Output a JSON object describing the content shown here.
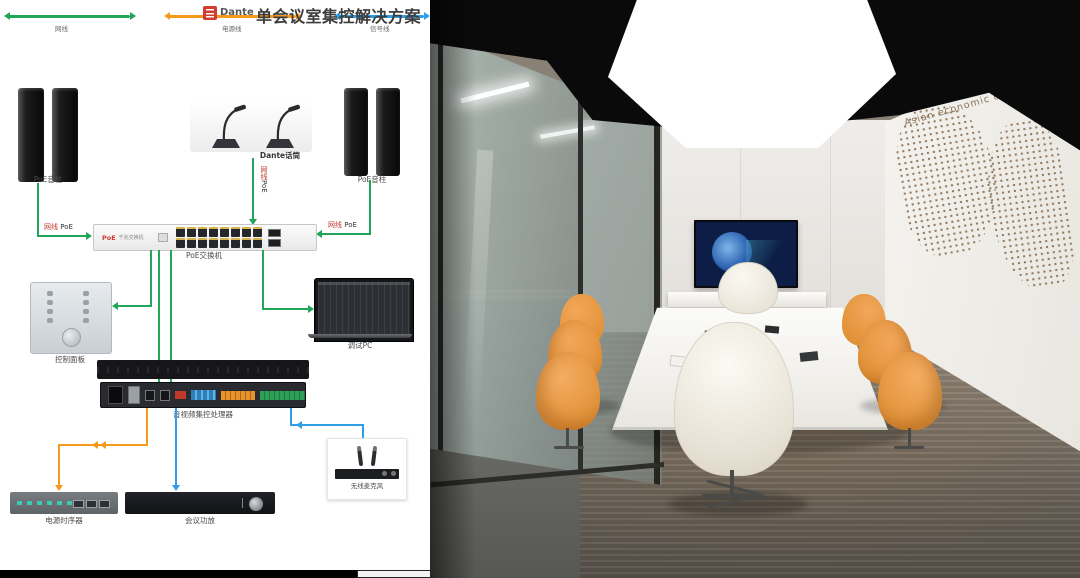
{
  "header": {
    "logo": "Dante",
    "title": "单会议室集控解决方案"
  },
  "legend": [
    {
      "label": "网线",
      "color": "#21a558"
    },
    {
      "label": "电源线",
      "color": "#f59a1d"
    },
    {
      "label": "信号线",
      "color": "#2e9fe6"
    }
  ],
  "cable": {
    "net": "网线",
    "poe": "PoE"
  },
  "devices": {
    "speakers_left": "PoE音柱",
    "mics": "Dante话筒",
    "speakers_right": "PoE音柱",
    "switch": {
      "face_brand": "PoE",
      "face_text": "千兆交换机",
      "label": "PoE交换机"
    },
    "panel": "控制面板",
    "laptop": "调试PC",
    "processor": "音视频集控处理器",
    "sequencer": "电源时序器",
    "amp": "会议功放",
    "wireless": "无线麦克风"
  },
  "photo": {
    "wall_text": "Asian economic development"
  },
  "colors": {
    "net": "#21a558",
    "power": "#f59a1d",
    "signal": "#2e9fe6",
    "brand_red": "#d23b2f"
  }
}
